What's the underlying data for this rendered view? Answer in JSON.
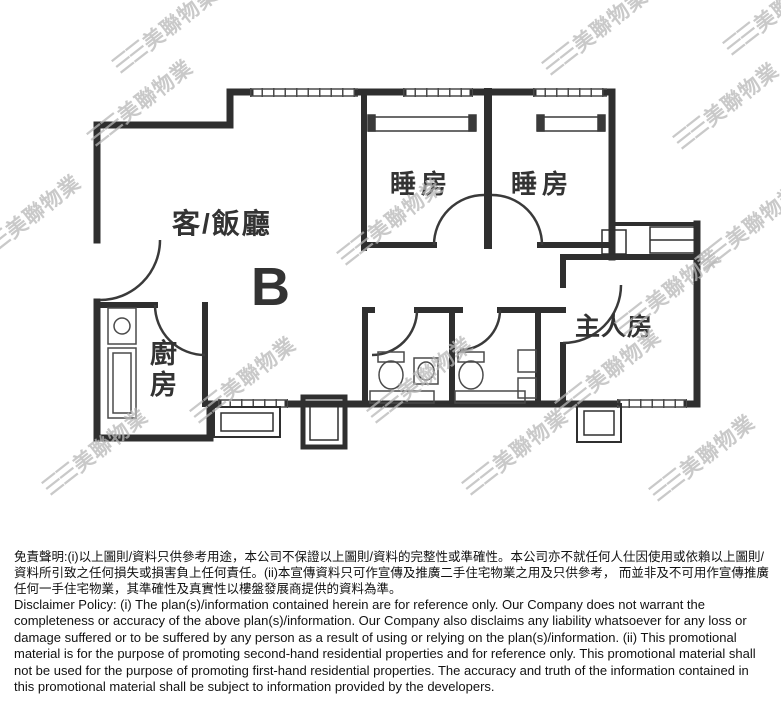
{
  "floorplan": {
    "unit_label": "B",
    "rooms": {
      "living_dining": "客/飯廳",
      "bedroom_1": "睡房",
      "bedroom_2": "睡房",
      "master_bedroom": "主人房",
      "kitchen": "廚房"
    }
  },
  "watermark": {
    "logo": "☰☰",
    "text": "美聯物業",
    "color": "#b8b8b8",
    "positions": [
      [
        165,
        30
      ],
      [
        595,
        32
      ],
      [
        776,
        12
      ],
      [
        140,
        103
      ],
      [
        726,
        106
      ],
      [
        28,
        218
      ],
      [
        390,
        222
      ],
      [
        748,
        228
      ],
      [
        668,
        292
      ],
      [
        243,
        380
      ],
      [
        420,
        380
      ],
      [
        608,
        372
      ],
      [
        95,
        452
      ],
      [
        515,
        452
      ],
      [
        702,
        458
      ]
    ]
  },
  "colors": {
    "wall": "#2f2f2f",
    "label": "#333333",
    "background": "#ffffff"
  },
  "disclaimer": {
    "zh": "免責聲明:(i)以上圖則/資料只供參考用途，本公司不保證以上圖則/資料的完整性或準確性。本公司亦不就任何人仕因使用或依賴以上圖則/資料所引致之任何損失或損害負上任何責任。(ii)本宣傳資料只可作宣傳及推廣二手住宅物業之用及只供參考， 而並非及不可用作宣傳推廣任何一手住宅物業，其準確性及真實性以樓盤發展商提供的資料為準。",
    "en": "Disclaimer Policy: (i) The plan(s)/information contained herein are for reference only. Our Company does not warrant the completeness or accuracy of the above plan(s)/information. Our Company also disclaims any liability whatsoever for any loss or damage suffered or to be suffered by any person as a result of using or relying on the plan(s)/information. (ii) This promotional material is for the purpose of promoting second-hand residential properties and for reference only. This promotional material shall not be used for the purpose of promoting first-hand residential properties. The accuracy and truth of the information contained in this promotional material shall be subject to information provided by the developers."
  }
}
